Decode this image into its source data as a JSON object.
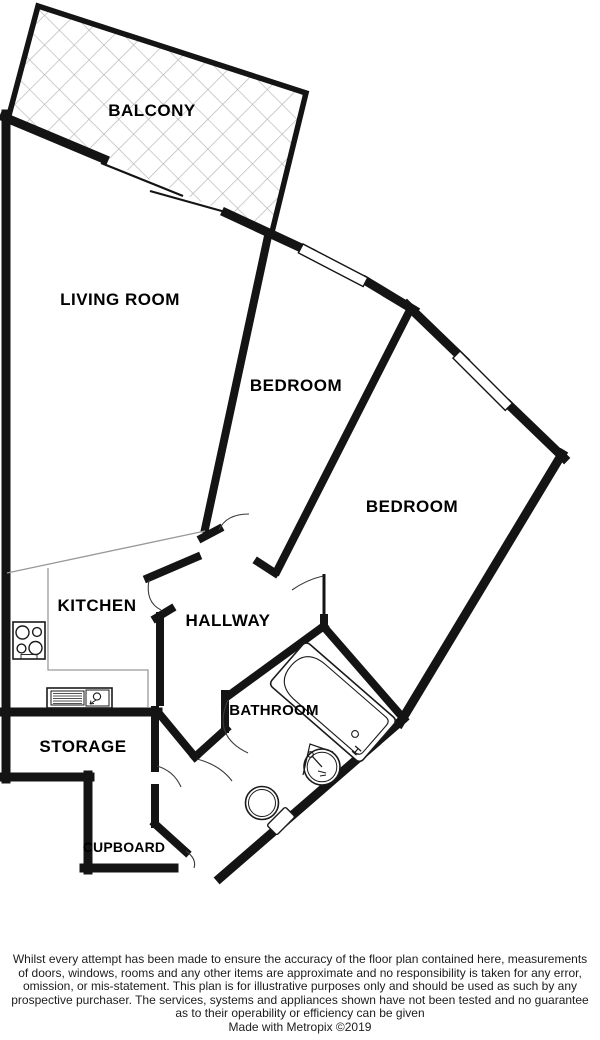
{
  "plan": {
    "rooms": {
      "balcony": "BALCONY",
      "living_room": "LIVING ROOM",
      "bedroom1": "BEDROOM",
      "bedroom2": "BEDROOM",
      "kitchen": "KITCHEN",
      "hallway": "HALLWAY",
      "bathroom": "BATHROOM",
      "storage": "STORAGE",
      "cupboard": "CUPBOARD"
    },
    "colors": {
      "wall": "#141414",
      "hatch_line": "#b4b4b4",
      "open_plan_divider": "#999999",
      "fixture_line": "#1a1a1a",
      "label_text": "#000000"
    },
    "icons": {
      "balcony_floor": "hatch-pattern",
      "windows": "window-icon",
      "balcony_door": "sliding-door-icon",
      "doors": "door-arc-icon",
      "hob": "hob-icon",
      "kitchen_sink": "sink-unit-icon",
      "bath": "bathtub-icon",
      "basin": "washbasin-icon",
      "toilet": "toilet-icon"
    }
  },
  "footer": {
    "disclaimer_lines": [
      "Whilst every attempt has been made to ensure the accuracy of the floor plan contained here, measurements",
      "of doors, windows, rooms and any other items are approximate and no responsibility is taken for any error,",
      "omission, or mis-statement. This plan is for illustrative purposes only and should be used as such by any",
      "prospective purchaser. The services, systems and appliances shown have not been tested and no guarantee",
      "as to their operability or efficiency can be given"
    ],
    "credit": "Made with Metropix ©2019"
  }
}
